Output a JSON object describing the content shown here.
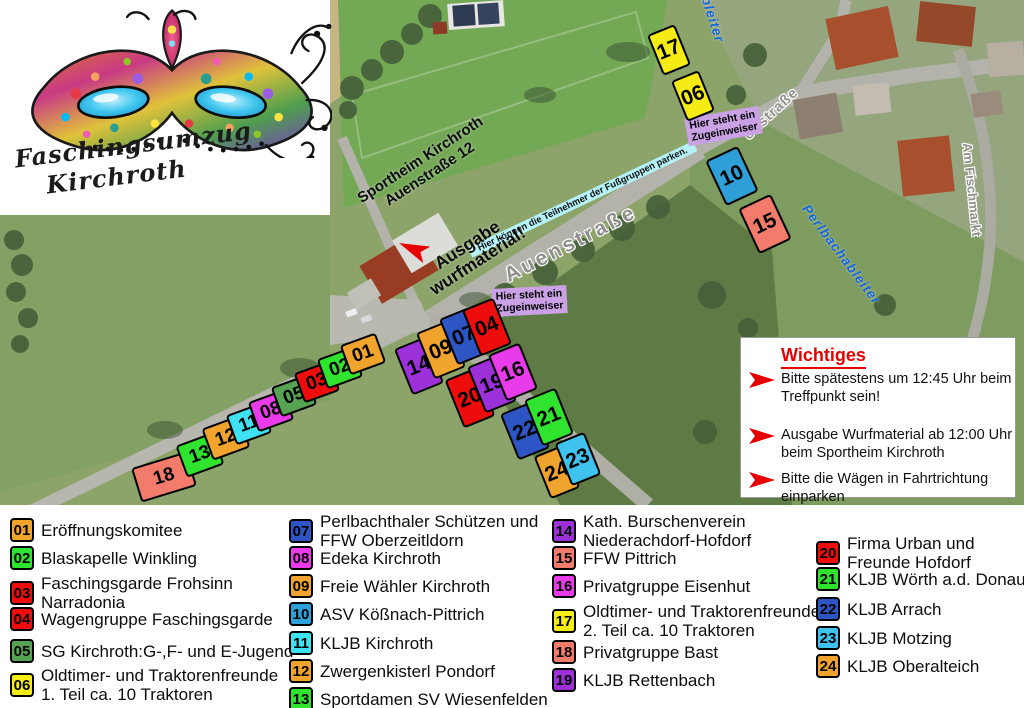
{
  "logo": {
    "line1": "Faschingsumzug",
    "line2": "Kirchroth"
  },
  "map": {
    "street_labels": {
      "auenstrasse": "Auenstraße",
      "auenstrasse_upper": "enstraße",
      "am_fischmarkt": "Am Fischmarkt",
      "perlbach_right": "Perlbachableiter",
      "perlbach_top": "Perlbachableiter"
    },
    "annotations": {
      "sportheim_line1": "Sportheim Kirchroth",
      "sportheim_line2": "Auenstraße 12",
      "ausgabe_line1": "Ausgabe",
      "ausgabe_line2": "wurfmaterial!",
      "zugeinweiser_line1": "Hier steht ein",
      "zugeinweiser_line2": "Zugeinweiser",
      "parken": "Hier können die Teilnehmer der Fußgruppen parken."
    },
    "boxes": [
      {
        "num": "18",
        "color": "#F37B6B",
        "x": 164,
        "y": 477,
        "w": 58,
        "h": 36,
        "rot": -17
      },
      {
        "num": "13",
        "color": "#2FE32F",
        "x": 200,
        "y": 455,
        "w": 40,
        "h": 34,
        "rot": -20
      },
      {
        "num": "12",
        "color": "#F0A42E",
        "x": 226,
        "y": 438,
        "w": 40,
        "h": 34,
        "rot": -20
      },
      {
        "num": "11",
        "color": "#3FE2F2",
        "x": 249,
        "y": 424,
        "w": 38,
        "h": 32,
        "rot": -20
      },
      {
        "num": "08",
        "color": "#EA3BEA",
        "x": 271,
        "y": 411,
        "w": 38,
        "h": 32,
        "rot": -20
      },
      {
        "num": "05",
        "color": "#55A353",
        "x": 294,
        "y": 396,
        "w": 38,
        "h": 32,
        "rot": -20
      },
      {
        "num": "03",
        "color": "#EE0D0D",
        "x": 317,
        "y": 382,
        "w": 38,
        "h": 32,
        "rot": -20
      },
      {
        "num": "02",
        "color": "#2FE32F",
        "x": 340,
        "y": 368,
        "w": 38,
        "h": 32,
        "rot": -20
      },
      {
        "num": "01",
        "color": "#F0A42E",
        "x": 363,
        "y": 354,
        "w": 38,
        "h": 32,
        "rot": -20
      },
      {
        "num": "14",
        "color": "#9C31DA",
        "x": 419,
        "y": 366,
        "w": 34,
        "h": 50,
        "rot": -22
      },
      {
        "num": "09",
        "color": "#F0A42E",
        "x": 441,
        "y": 350,
        "w": 34,
        "h": 50,
        "rot": -22
      },
      {
        "num": "07",
        "color": "#2D55C4",
        "x": 464,
        "y": 336,
        "w": 34,
        "h": 50,
        "rot": -22
      },
      {
        "num": "04",
        "color": "#EE0D0D",
        "x": 487,
        "y": 327,
        "w": 34,
        "h": 50,
        "rot": -22
      },
      {
        "num": "20",
        "color": "#EE0D0D",
        "x": 470,
        "y": 398,
        "w": 34,
        "h": 52,
        "rot": -22
      },
      {
        "num": "19",
        "color": "#9C31DA",
        "x": 492,
        "y": 384,
        "w": 34,
        "h": 50,
        "rot": -22
      },
      {
        "num": "16",
        "color": "#EA3BEA",
        "x": 513,
        "y": 372,
        "w": 34,
        "h": 50,
        "rot": -22
      },
      {
        "num": "22",
        "color": "#2D55C4",
        "x": 525,
        "y": 431,
        "w": 34,
        "h": 50,
        "rot": -22
      },
      {
        "num": "21",
        "color": "#2FE32F",
        "x": 549,
        "y": 417,
        "w": 34,
        "h": 50,
        "rot": -22
      },
      {
        "num": "24",
        "color": "#F0A42E",
        "x": 557,
        "y": 472,
        "w": 32,
        "h": 46,
        "rot": -22
      },
      {
        "num": "23",
        "color": "#3FC3EE",
        "x": 578,
        "y": 459,
        "w": 32,
        "h": 46,
        "rot": -22
      },
      {
        "num": "17",
        "color": "#F4EC14",
        "x": 669,
        "y": 50,
        "w": 30,
        "h": 44,
        "rot": -22
      },
      {
        "num": "06",
        "color": "#F4EC14",
        "x": 693,
        "y": 96,
        "w": 30,
        "h": 44,
        "rot": -22
      },
      {
        "num": "10",
        "color": "#2E9FD9",
        "x": 732,
        "y": 176,
        "w": 36,
        "h": 50,
        "rot": -25
      },
      {
        "num": "15",
        "color": "#F37B6B",
        "x": 765,
        "y": 224,
        "w": 36,
        "h": 50,
        "rot": -25
      }
    ]
  },
  "legend": {
    "columns": [
      [
        {
          "num": "01",
          "color": "#F0A42E",
          "label": [
            "Eröffnungskomitee"
          ]
        },
        {
          "num": "02",
          "color": "#2FE32F",
          "label": [
            "Blaskapelle Winkling"
          ]
        },
        {
          "num": "03",
          "color": "#EE0D0D",
          "label": [
            "Faschingsgarde Frohsinn",
            "Narradonia"
          ]
        },
        {
          "num": "04",
          "color": "#EE0D0D",
          "label": [
            "Wagengruppe Faschingsgarde"
          ]
        },
        {
          "num": "05",
          "color": "#55A353",
          "label": [
            "SG Kirchroth:G-,F- und E-Jugend"
          ]
        },
        {
          "num": "06",
          "color": "#F4EC14",
          "label": [
            "Oldtimer- und Traktorenfreunde",
            "1. Teil ca. 10 Traktoren"
          ]
        }
      ],
      [
        {
          "num": "07",
          "color": "#2D55C4",
          "label": [
            "Perlbachthaler Schützen und",
            "FFW Oberzeitldorn"
          ]
        },
        {
          "num": "08",
          "color": "#EA3BEA",
          "label": [
            "Edeka Kirchroth"
          ]
        },
        {
          "num": "09",
          "color": "#F0A42E",
          "label": [
            "Freie Wähler Kirchroth"
          ]
        },
        {
          "num": "10",
          "color": "#2E9FD9",
          "label": [
            "ASV Kößnach-Pittrich"
          ]
        },
        {
          "num": "11",
          "color": "#3FE2F2",
          "label": [
            "KLJB Kirchroth"
          ]
        },
        {
          "num": "12",
          "color": "#F0A42E",
          "label": [
            "Zwergenkisterl Pondorf"
          ]
        },
        {
          "num": "13",
          "color": "#2FE32F",
          "label": [
            "Sportdamen SV Wiesenfelden"
          ]
        }
      ],
      [
        {
          "num": "14",
          "color": "#9C31DA",
          "label": [
            "Kath. Burschenverein",
            "Niederachdorf-Hofdorf"
          ]
        },
        {
          "num": "15",
          "color": "#F37B6B",
          "label": [
            "FFW Pittrich"
          ]
        },
        {
          "num": "16",
          "color": "#EA3BEA",
          "label": [
            "Privatgruppe Eisenhut"
          ]
        },
        {
          "num": "17",
          "color": "#F4EC14",
          "label": [
            "Oldtimer- und Traktorenfreunde",
            "2. Teil ca. 10 Traktoren"
          ]
        },
        {
          "num": "18",
          "color": "#F37B6B",
          "label": [
            "Privatgruppe Bast"
          ]
        },
        {
          "num": "19",
          "color": "#9C31DA",
          "label": [
            "KLJB Rettenbach"
          ]
        }
      ],
      [
        {
          "num": "20",
          "color": "#EE0D0D",
          "label": [
            "Firma Urban und",
            "Freunde Hofdorf"
          ]
        },
        {
          "num": "21",
          "color": "#2FE32F",
          "label": [
            "KLJB Wörth a.d. Donau"
          ]
        },
        {
          "num": "22",
          "color": "#2D55C4",
          "label": [
            "KLJB Arrach"
          ]
        },
        {
          "num": "23",
          "color": "#3FC3EE",
          "label": [
            "KLJB Motzing"
          ]
        },
        {
          "num": "24",
          "color": "#F0A42E",
          "label": [
            "KLJB Oberalteich"
          ]
        }
      ]
    ]
  },
  "wichtiges": {
    "title": "Wichtiges",
    "arrow_color": "#E60000",
    "items": [
      "Bitte spätestens um 12:45 Uhr beim Treffpunkt sein!",
      "Ausgabe Wurfmaterial ab 12:00 Uhr beim Sportheim Kirchroth",
      "Bitte die Wägen in Fahrtrichtung einparken"
    ]
  }
}
